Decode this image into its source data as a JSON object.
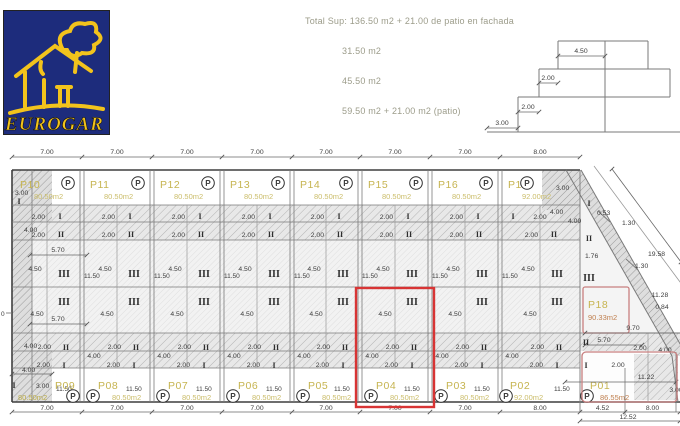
{
  "meta": {
    "doc_type": "garage floor plan drawing",
    "highlighted_plot": "P04"
  },
  "colors": {
    "logo_bg": "#1d2c7c",
    "logo_yellow": "#f2c31c",
    "plot_label": "#c6b450",
    "plot_area": "#cbbd6a",
    "area_red": "#c08050",
    "summary_text": "#9c9c8a",
    "line": "#7a7a7a",
    "dim_text": "#3c3c3c",
    "marker": "#2e2e2e",
    "highlight_red": "#d83434",
    "soft_red": "#c87f7f"
  },
  "logo": {
    "brand": "EUROGAR",
    "graphic": "house-and-tree-sketch"
  },
  "summary": {
    "title_line": "Total Sup: 136.50 m2 + 21.00 de patio en fachada",
    "area_lines": [
      "31.50 m2",
      "45.50 m2",
      "59.50 m2 + 21.00 m2 (patio)"
    ]
  },
  "section_profile": {
    "dim_top": "4.50",
    "dim_mid": "2.00",
    "dim_low": "2.00",
    "dim_base": "3.00"
  },
  "plan": {
    "top_width_dims": [
      "7.00",
      "7.00",
      "7.00",
      "7.00",
      "7.00",
      "7.00",
      "7.00",
      "8.00"
    ],
    "bottom_width_dims": [
      "7.00",
      "7.00",
      "7.00",
      "7.00",
      "7.00",
      "7.00",
      "7.00",
      "8.00",
      "4.52",
      "8.00"
    ],
    "overall_dim": "12.52",
    "depth_dim": "11.50",
    "row_dims": {
      "zone1": "2.00",
      "zone2": "2.00",
      "zone3": "4.50",
      "left_span": "4.00",
      "sub": "5.70",
      "boundary_span": "4.00"
    },
    "zone_markers": [
      "I",
      "II",
      "III"
    ],
    "parking_symbol": "P",
    "top_plots": [
      {
        "id": "P10",
        "area": "80.50m2"
      },
      {
        "id": "P11",
        "area": "80.50m2"
      },
      {
        "id": "P12",
        "area": "80.50m2"
      },
      {
        "id": "P13",
        "area": "80.50m2"
      },
      {
        "id": "P14",
        "area": "80.50m2"
      },
      {
        "id": "P15",
        "area": "80.50m2"
      },
      {
        "id": "P16",
        "area": "80.50m2"
      },
      {
        "id": "P17",
        "area": "92.00m2"
      }
    ],
    "bottom_plots": [
      {
        "id": "P09",
        "area": "80.50m2"
      },
      {
        "id": "P08",
        "area": "80.50m2"
      },
      {
        "id": "P07",
        "area": "80.50m2"
      },
      {
        "id": "P06",
        "area": "80.50m2"
      },
      {
        "id": "P05",
        "area": "80.50m2"
      },
      {
        "id": "P04",
        "area": "80.50m2",
        "highlight": true
      },
      {
        "id": "P03",
        "area": "80.50m2"
      },
      {
        "id": "P02",
        "area": "92.00m2"
      },
      {
        "id": "P01",
        "area": "86.55m2"
      }
    ],
    "corner_plot": {
      "id": "P18",
      "area": "90.33m2"
    },
    "left_edge_dims": {
      "top_corner": "3.00",
      "upper_span": "4.00",
      "datum": "0",
      "lower_span": "4.00",
      "bottom_corner": "3.00"
    },
    "corner_dims": {
      "width": "3.00",
      "step1": "4.00",
      "step2": "4.00"
    },
    "right_edge_dims": {
      "diagonal_total": "19.58",
      "diag_tick1": "1.30",
      "diag_tick2": "1.30",
      "offset1": "0.53",
      "offset2": "1.76",
      "edge1": "11.28",
      "edge2": "0.84",
      "front": "9.70",
      "front_sub": "5.70",
      "front_small": "2.00",
      "side": "4.00",
      "inner_small": "2.00",
      "inner_span": "11.22",
      "corner": "3.00"
    }
  }
}
